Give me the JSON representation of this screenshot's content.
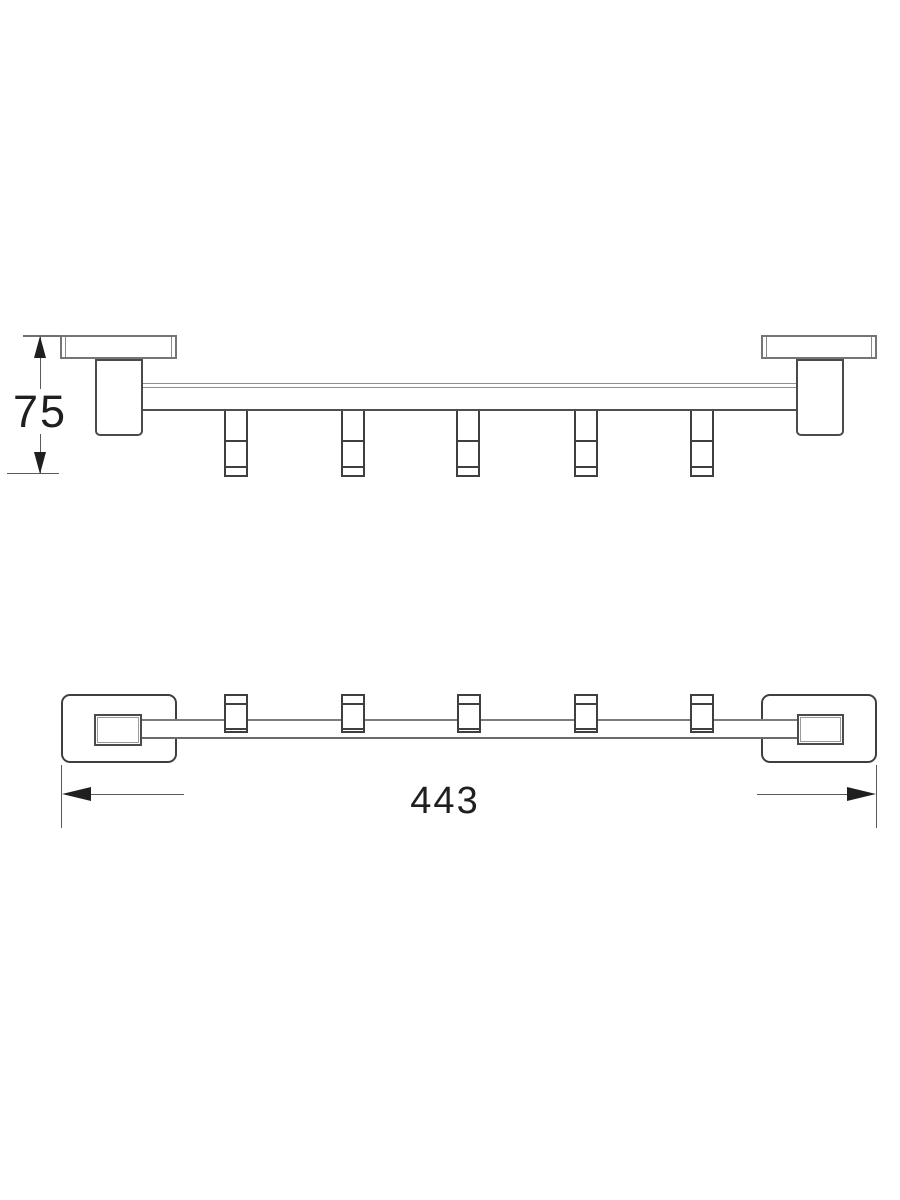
{
  "drawing": {
    "type": "technical-dimension-drawing",
    "subject": "towel-hook-rail-5-hooks",
    "views": {
      "front": {
        "name": "front-elevation",
        "dimension": {
          "label": "75",
          "orientation": "vertical"
        }
      },
      "plan": {
        "name": "plan-view",
        "dimension": {
          "label": "443",
          "orientation": "horizontal"
        }
      }
    },
    "colors": {
      "background": "#ffffff",
      "line_dark": "#3f3f3f",
      "line_mid": "#757575",
      "line_light": "#8f8f8f",
      "dimension_text": "#1f1f1f"
    }
  }
}
